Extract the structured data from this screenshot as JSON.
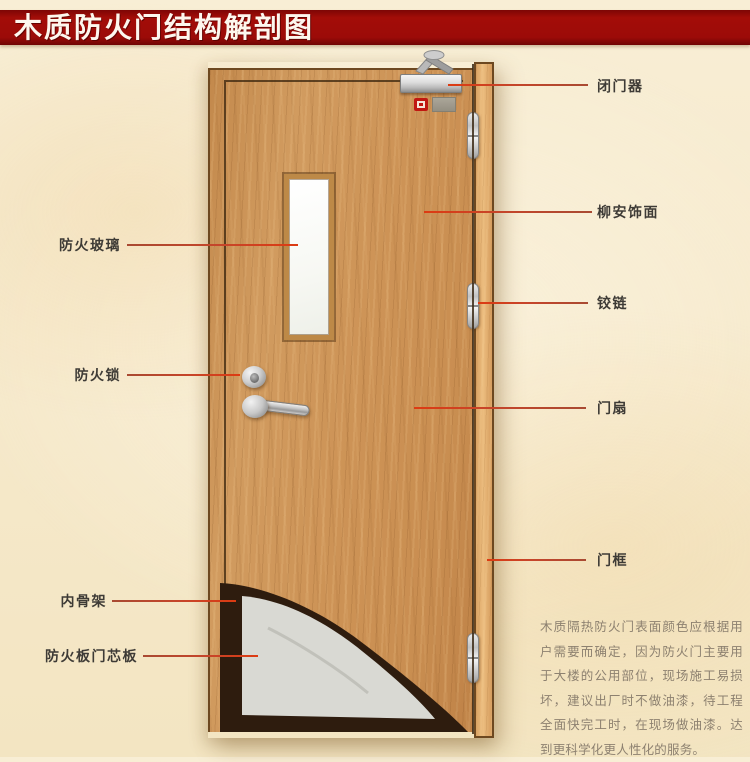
{
  "title": "木质防火门结构解剖图",
  "labels": {
    "right": [
      {
        "text": "闭门器"
      },
      {
        "text": "柳安饰面"
      },
      {
        "text": "铰链"
      },
      {
        "text": "门扇"
      },
      {
        "text": "门框"
      }
    ],
    "left": [
      {
        "text": "防火玻璃"
      },
      {
        "text": "防火锁"
      },
      {
        "text": "内骨架"
      },
      {
        "text": "防火板门芯板"
      }
    ]
  },
  "description": "木质隔热防火门表面颜色应根据用户需要而确定，因为防火门主要用于大楼的公用部位，现场施工易损坏，建议出厂时不做油漆，待工程全面快完工时，在现场做油漆。达到更科学化更人性化的服务。",
  "colors": {
    "banner_red": "#9e0b0a",
    "callout_line": "#c6452a",
    "door_wood": "#cf9659",
    "frame_wood": "#e2ab67",
    "core_board_grey": "#d9d9d3",
    "inner_skeleton_dark": "#2e1c0e",
    "label_text": "#3e3b36",
    "description_text": "#8d8170",
    "background_beige": "#f6e9cb"
  }
}
